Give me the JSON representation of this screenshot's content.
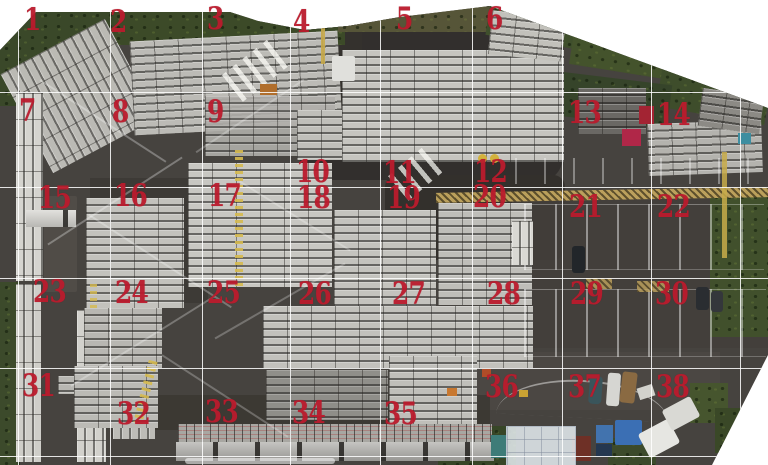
{
  "canvas": {
    "width": 768,
    "height": 465,
    "page_background": "#ffffff"
  },
  "photo": {
    "base_color": "#46433f",
    "clip": [
      [
        0,
        50
      ],
      [
        36,
        12
      ],
      [
        230,
        12
      ],
      [
        258,
        21
      ],
      [
        305,
        30
      ],
      [
        348,
        26
      ],
      [
        400,
        17
      ],
      [
        490,
        6
      ],
      [
        768,
        108
      ],
      [
        768,
        355
      ],
      [
        712,
        465
      ],
      [
        0,
        465
      ]
    ]
  },
  "grid": {
    "line_color": "rgba(255,255,255,0.85)",
    "vertical_x": [
      18,
      110,
      202,
      290,
      380,
      472,
      562,
      651,
      740
    ],
    "horizontal_y": [
      92,
      187,
      278,
      368,
      456
    ]
  },
  "labels": {
    "color": "#bb1b2d",
    "items": [
      {
        "n": "1",
        "x": 24,
        "y": 10
      },
      {
        "n": "2",
        "x": 110,
        "y": 12
      },
      {
        "n": "3",
        "x": 207,
        "y": 9
      },
      {
        "n": "4",
        "x": 293,
        "y": 12
      },
      {
        "n": "5",
        "x": 396,
        "y": 9
      },
      {
        "n": "6",
        "x": 486,
        "y": 9
      },
      {
        "n": "7",
        "x": 19,
        "y": 101
      },
      {
        "n": "8",
        "x": 112,
        "y": 102
      },
      {
        "n": "9",
        "x": 207,
        "y": 102
      },
      {
        "n": "10",
        "x": 296,
        "y": 162
      },
      {
        "n": "11",
        "x": 383,
        "y": 163
      },
      {
        "n": "12",
        "x": 474,
        "y": 162
      },
      {
        "n": "13",
        "x": 568,
        "y": 103
      },
      {
        "n": "14",
        "x": 657,
        "y": 105
      },
      {
        "n": "15",
        "x": 38,
        "y": 188
      },
      {
        "n": "16",
        "x": 114,
        "y": 186
      },
      {
        "n": "17",
        "x": 208,
        "y": 186
      },
      {
        "n": "18",
        "x": 297,
        "y": 188
      },
      {
        "n": "19",
        "x": 387,
        "y": 188
      },
      {
        "n": "20",
        "x": 473,
        "y": 187
      },
      {
        "n": "21",
        "x": 569,
        "y": 197
      },
      {
        "n": "22",
        "x": 657,
        "y": 197
      },
      {
        "n": "23",
        "x": 33,
        "y": 282
      },
      {
        "n": "24",
        "x": 115,
        "y": 283
      },
      {
        "n": "25",
        "x": 207,
        "y": 283
      },
      {
        "n": "26",
        "x": 298,
        "y": 284
      },
      {
        "n": "27",
        "x": 392,
        "y": 284
      },
      {
        "n": "28",
        "x": 487,
        "y": 284
      },
      {
        "n": "29",
        "x": 570,
        "y": 284
      },
      {
        "n": "30",
        "x": 655,
        "y": 284
      },
      {
        "n": "31",
        "x": 22,
        "y": 376
      },
      {
        "n": "32",
        "x": 117,
        "y": 404
      },
      {
        "n": "33",
        "x": 205,
        "y": 402
      },
      {
        "n": "34",
        "x": 292,
        "y": 403
      },
      {
        "n": "35",
        "x": 384,
        "y": 404
      },
      {
        "n": "36",
        "x": 485,
        "y": 377
      },
      {
        "n": "37",
        "x": 568,
        "y": 377
      },
      {
        "n": "38",
        "x": 656,
        "y": 377
      }
    ]
  },
  "regions": [
    {
      "n": "dark-wet-asphalt",
      "x": 300,
      "y": 18,
      "w": 262,
      "h": 162,
      "c": "#302e2b",
      "o": 0.9,
      "br": 20
    },
    {
      "n": "gate-road",
      "x": 300,
      "y": 20,
      "w": 62,
      "h": 140,
      "c": "#34312d"
    },
    {
      "n": "dark-asphalt-mid",
      "x": 385,
      "y": 175,
      "w": 180,
      "h": 85,
      "c": "#33302c",
      "br": 12
    },
    {
      "n": "asphalt-alley",
      "x": 90,
      "y": 178,
      "w": 118,
      "h": 125,
      "c": "#3b3834",
      "o": 0.8
    },
    {
      "n": "road-bottom",
      "x": 470,
      "y": 352,
      "w": 250,
      "h": 58,
      "c": "#4b4844",
      "o": 0.9
    },
    {
      "n": "parking-lot",
      "x": 512,
      "y": 198,
      "w": 256,
      "h": 150,
      "c": "#423f3b",
      "o": 0.9
    },
    {
      "n": "asphalt-bottom",
      "x": 150,
      "y": 395,
      "w": 340,
      "h": 35,
      "c": "#38352f",
      "o": 0.7
    },
    {
      "n": "hedge-top",
      "x": 60,
      "y": 0,
      "w": 285,
      "h": 45,
      "c": "#3c4a28",
      "p": "veg"
    },
    {
      "n": "hedge-top-right",
      "x": 338,
      "y": 0,
      "w": 160,
      "h": 32,
      "c": "#565538",
      "p": "veg"
    },
    {
      "n": "vegetation-topleft",
      "x": 0,
      "y": 10,
      "w": 114,
      "h": 96,
      "c": "#3a4829",
      "p": "veg"
    },
    {
      "n": "hedge-ne-1",
      "x": 488,
      "y": 2,
      "w": 115,
      "h": 42,
      "c": "#3f4f2c",
      "p": "veg",
      "r": 9
    },
    {
      "n": "hedge-ne-2",
      "x": 572,
      "y": 26,
      "w": 125,
      "h": 48,
      "c": "#44532c",
      "p": "veg",
      "r": 9
    },
    {
      "n": "hedge-ne-3",
      "x": 660,
      "y": 58,
      "w": 110,
      "h": 58,
      "c": "#3e4d2b",
      "p": "veg",
      "r": 10
    },
    {
      "n": "hedge-ne-4",
      "x": 552,
      "y": 78,
      "w": 118,
      "h": 44,
      "c": "#36442a",
      "p": "veg",
      "r": 7
    },
    {
      "n": "vegetation-right",
      "x": 710,
      "y": 192,
      "w": 58,
      "h": 145,
      "c": "#41502c",
      "p": "veg"
    },
    {
      "n": "vegetation-left-edge",
      "x": 0,
      "y": 282,
      "w": 20,
      "h": 183,
      "c": "#3c4a2b",
      "p": "veg"
    },
    {
      "n": "vegetation-bottom-mid",
      "x": 438,
      "y": 426,
      "w": 78,
      "h": 39,
      "c": "#374627",
      "p": "veg"
    },
    {
      "n": "vegetation-bottom-right",
      "x": 608,
      "y": 438,
      "w": 48,
      "h": 27,
      "c": "#3c4a2b",
      "p": "veg"
    },
    {
      "n": "vegetation-br-2",
      "x": 690,
      "y": 383,
      "w": 38,
      "h": 40,
      "c": "#46552e",
      "p": "veg"
    },
    {
      "n": "vegetation-br-3",
      "x": 715,
      "y": 408,
      "w": 30,
      "h": 45,
      "c": "#3a4827",
      "p": "veg"
    },
    {
      "n": "herringbone-trucks",
      "x": 20,
      "y": 40,
      "w": 118,
      "h": 112,
      "c": "#c2c1bc",
      "p": "stacks-v",
      "r": -28,
      "o": 0.95
    },
    {
      "n": "stack-rows-zone2",
      "x": 132,
      "y": 36,
      "w": 208,
      "h": 94,
      "c": "#bcbbb6",
      "p": "stacks",
      "r": -3
    },
    {
      "n": "stack-rows-zone9",
      "x": 205,
      "y": 96,
      "w": 130,
      "h": 60,
      "c": "#b0afaa",
      "p": "stacks",
      "o": 0.9
    },
    {
      "n": "stack-small-zone10",
      "x": 297,
      "y": 110,
      "w": 45,
      "h": 50,
      "c": "#c0bfba",
      "p": "stacks"
    },
    {
      "n": "stack-block-zone5",
      "x": 342,
      "y": 50,
      "w": 222,
      "h": 112,
      "c": "#c6c5c0",
      "p": "stacks"
    },
    {
      "n": "stack-block-zone6",
      "x": 490,
      "y": 14,
      "w": 74,
      "h": 44,
      "c": "#c2c1bb",
      "p": "stacks",
      "r": 6
    },
    {
      "n": "dark-stacks-zone13",
      "x": 578,
      "y": 88,
      "w": 68,
      "h": 46,
      "c": "#6a6864",
      "p": "stacks"
    },
    {
      "n": "stack-rows-zone14",
      "x": 648,
      "y": 122,
      "w": 114,
      "h": 52,
      "c": "#b4b3ae",
      "p": "stacks",
      "r": -2
    },
    {
      "n": "stacks-zone14-top",
      "x": 700,
      "y": 92,
      "w": 62,
      "h": 38,
      "c": "#8c8a85",
      "p": "stacks",
      "r": 8
    },
    {
      "n": "trailers-left-1",
      "x": 16,
      "y": 93,
      "w": 27,
      "h": 188,
      "c": "#d5d4cf",
      "p": "stacks-v"
    },
    {
      "n": "trailers-left-2",
      "x": 16,
      "y": 284,
      "w": 25,
      "h": 178,
      "c": "#cfcec9",
      "p": "stacks-v"
    },
    {
      "n": "dark-roof-building",
      "x": 44,
      "y": 196,
      "w": 33,
      "h": 96,
      "c": "#504c47",
      "br": 2
    },
    {
      "n": "trucks-horizontal",
      "x": 26,
      "y": 210,
      "w": 50,
      "h": 17,
      "c": "#d8d7d2",
      "p": "segments"
    },
    {
      "n": "trailers-zone31-a",
      "x": 77,
      "y": 310,
      "w": 29,
      "h": 152,
      "c": "#d2d1cc",
      "p": "stacks-v"
    },
    {
      "n": "trailers-zone31-b",
      "x": 113,
      "y": 313,
      "w": 42,
      "h": 126,
      "c": "#bdbcb7",
      "p": "stacks-v"
    },
    {
      "n": "stack-small-zone31",
      "x": 58,
      "y": 376,
      "w": 32,
      "h": 18,
      "c": "#b8b7b2",
      "p": "stacks"
    },
    {
      "n": "stack-block-zone16a",
      "x": 86,
      "y": 198,
      "w": 98,
      "h": 110,
      "c": "#c3c2bd",
      "p": "stacks"
    },
    {
      "n": "stack-block-zone17",
      "x": 188,
      "y": 163,
      "w": 144,
      "h": 124,
      "c": "#c8c7c2",
      "p": "stacks"
    },
    {
      "n": "stack-block-zone19",
      "x": 334,
      "y": 210,
      "w": 102,
      "h": 98,
      "c": "#c4c3be",
      "p": "stacks"
    },
    {
      "n": "stack-block-zone20",
      "x": 438,
      "y": 203,
      "w": 94,
      "h": 102,
      "c": "#bfbeb9",
      "p": "stacks"
    },
    {
      "n": "stack-block-zone24",
      "x": 84,
      "y": 308,
      "w": 78,
      "h": 60,
      "c": "#b8b7b2",
      "p": "stacks"
    },
    {
      "n": "stack-band-zone26",
      "x": 263,
      "y": 306,
      "w": 270,
      "h": 62,
      "c": "#c2c1bc",
      "p": "stacks"
    },
    {
      "n": "stack-block-zone32",
      "x": 74,
      "y": 366,
      "w": 84,
      "h": 62,
      "c": "#bbbab5",
      "p": "stacks"
    },
    {
      "n": "stack-block-zone35",
      "x": 389,
      "y": 356,
      "w": 88,
      "h": 74,
      "c": "#c0bfba",
      "p": "stacks"
    },
    {
      "n": "stack-sparse-zone33",
      "x": 266,
      "y": 370,
      "w": 122,
      "h": 50,
      "c": "#9e9d98",
      "p": "stacks",
      "o": 0.85
    },
    {
      "n": "speckle-stack-row",
      "x": 178,
      "y": 424,
      "w": 314,
      "h": 19,
      "c": "#a8a7a2",
      "p": "speckle"
    },
    {
      "n": "slab-row-ww",
      "x": 176,
      "y": 442,
      "w": 318,
      "h": 19,
      "c": "#b2b1ad",
      "p": "segments"
    },
    {
      "n": "white-curb-bottom",
      "x": 185,
      "y": 458,
      "w": 150,
      "h": 6,
      "c": "rgba(255,255,255,0.55)",
      "br": 3
    },
    {
      "n": "zebra-crossing-gate",
      "x": 226,
      "y": 53,
      "w": 60,
      "h": 34,
      "p": "zebra",
      "r": -38,
      "o": 0.85
    },
    {
      "n": "zebra-crossing-mid",
      "x": 393,
      "y": 158,
      "w": 45,
      "h": 32,
      "p": "zebra",
      "r": -40,
      "o": 0.8
    },
    {
      "n": "yellow-pipe-rack",
      "x": 436,
      "y": 190,
      "w": 332,
      "h": 10,
      "c": "#c2a55e",
      "p": "hatch-y",
      "r": -1,
      "o": 0.95
    },
    {
      "n": "white-post-row",
      "x": 515,
      "y": 158,
      "w": 253,
      "h": 26,
      "p": "posts",
      "o": 0.6
    },
    {
      "n": "parking-slots-row1",
      "x": 524,
      "y": 204,
      "w": 240,
      "h": 64,
      "p": "slots",
      "o": 0.8
    },
    {
      "n": "parking-slots-row2",
      "x": 524,
      "y": 289,
      "w": 242,
      "h": 66,
      "p": "slots",
      "o": 0.8
    },
    {
      "n": "yellow-hatch-1",
      "x": 586,
      "y": 278,
      "w": 26,
      "h": 11,
      "c": "#c2a55e",
      "p": "hatch-y",
      "o": 0.8
    },
    {
      "n": "yellow-hatch-2",
      "x": 637,
      "y": 281,
      "w": 32,
      "h": 11,
      "c": "#c2a55e",
      "p": "hatch-y",
      "o": 0.8
    },
    {
      "n": "yellow-line-right",
      "x": 722,
      "y": 152,
      "w": 5,
      "h": 106,
      "c": "#c8ab4a",
      "o": 0.85
    },
    {
      "n": "yellow-line-gate",
      "x": 321,
      "y": 28,
      "w": 4,
      "h": 36,
      "c": "#c8ab4a",
      "o": 0.9
    },
    {
      "n": "crane-truss-1",
      "x": 235,
      "y": 150,
      "w": 8,
      "h": 138,
      "p": "truss-v",
      "o": 0.9
    },
    {
      "n": "crane-truss-2",
      "x": 141,
      "y": 360,
      "w": 9,
      "h": 64,
      "p": "truss-v",
      "r": 14,
      "o": 0.9
    },
    {
      "n": "crane-truss-3",
      "x": 90,
      "y": 284,
      "w": 7,
      "h": 28,
      "p": "truss-v",
      "o": 0.8
    },
    {
      "n": "lane-mark-1",
      "x": 28,
      "y": 120,
      "w": 150,
      "h": 2,
      "c": "rgba(255,255,255,0.3)",
      "r": 33
    },
    {
      "n": "lane-mark-2",
      "x": 35,
      "y": 200,
      "w": 160,
      "h": 2,
      "c": "rgba(255,255,255,0.3)",
      "r": -33
    },
    {
      "n": "lane-mark-3",
      "x": 75,
      "y": 260,
      "w": 170,
      "h": 2,
      "c": "rgba(255,255,255,0.28)",
      "r": 33
    },
    {
      "n": "lane-mark-4",
      "x": 58,
      "y": 340,
      "w": 170,
      "h": 2,
      "c": "rgba(255,255,255,0.28)",
      "r": -32
    },
    {
      "n": "lane-mark-5",
      "x": 150,
      "y": 395,
      "w": 150,
      "h": 2,
      "c": "rgba(255,255,255,0.25)",
      "r": 33
    },
    {
      "n": "lane-mark-6",
      "x": 185,
      "y": 115,
      "w": 130,
      "h": 2,
      "c": "rgba(255,255,255,0.25)",
      "r": -34
    },
    {
      "n": "lane-mark-7",
      "x": 205,
      "y": 300,
      "w": 150,
      "h": 2,
      "c": "rgba(255,255,255,0.25)",
      "r": -30
    },
    {
      "n": "lane-mark-8",
      "x": 230,
      "y": 215,
      "w": 130,
      "h": 2,
      "c": "rgba(255,255,255,0.25)",
      "r": 32
    },
    {
      "n": "yellow-dot-1",
      "x": 478,
      "y": 154,
      "w": 9,
      "h": 9,
      "c": "#d3b23c",
      "br": 5
    },
    {
      "n": "yellow-dot-2",
      "x": 490,
      "y": 154,
      "w": 9,
      "h": 9,
      "c": "#d3b23c",
      "br": 5
    },
    {
      "n": "road-curve-mark",
      "x": 497,
      "y": 380,
      "w": 172,
      "h": 36,
      "p": "arc",
      "r": 3
    },
    {
      "n": "white-vans-parking",
      "x": 512,
      "y": 221,
      "w": 21,
      "h": 44,
      "c": "#d9d8d3",
      "p": "stacks-v"
    },
    {
      "n": "parked-car-dark",
      "x": 572,
      "y": 246,
      "w": 13,
      "h": 27,
      "c": "#22262a",
      "br": 3
    },
    {
      "n": "parked-car-2",
      "x": 696,
      "y": 287,
      "w": 13,
      "h": 23,
      "c": "#2a2d31",
      "br": 3
    },
    {
      "n": "parked-car-3",
      "x": 711,
      "y": 291,
      "w": 12,
      "h": 21,
      "c": "#34373b",
      "br": 3
    },
    {
      "n": "suv-road",
      "x": 589,
      "y": 376,
      "w": 13,
      "h": 28,
      "c": "#3a555b",
      "br": 4,
      "r": 4
    },
    {
      "n": "truck-cab-white",
      "x": 607,
      "y": 373,
      "w": 13,
      "h": 33,
      "c": "#d6d6d2",
      "br": 3,
      "r": 4
    },
    {
      "n": "truck-cargo-brown",
      "x": 621,
      "y": 372,
      "w": 15,
      "h": 31,
      "c": "#8a6a42",
      "br": 3,
      "r": 7
    },
    {
      "n": "forklift-orange",
      "x": 447,
      "y": 388,
      "w": 10,
      "h": 8,
      "c": "#c87830"
    },
    {
      "n": "forklift-yellow",
      "x": 519,
      "y": 390,
      "w": 9,
      "h": 7,
      "c": "#c9a233"
    },
    {
      "n": "orange-item-road",
      "x": 482,
      "y": 369,
      "w": 9,
      "h": 8,
      "c": "#b04c28"
    },
    {
      "n": "red-item-zone13",
      "x": 639,
      "y": 106,
      "w": 15,
      "h": 18,
      "c": "#a32433"
    },
    {
      "n": "magenta-item-zone13",
      "x": 622,
      "y": 129,
      "w": 19,
      "h": 17,
      "c": "#b02748"
    },
    {
      "n": "teal-container-right",
      "x": 738,
      "y": 133,
      "w": 13,
      "h": 11,
      "c": "#3e8ea0"
    },
    {
      "n": "gate-hut",
      "x": 332,
      "y": 56,
      "w": 23,
      "h": 25,
      "c": "#e0e0dc",
      "br": 2
    },
    {
      "n": "orange-machine-gate",
      "x": 260,
      "y": 84,
      "w": 17,
      "h": 11,
      "c": "#b06e2c"
    },
    {
      "n": "blue-container",
      "x": 615,
      "y": 420,
      "w": 27,
      "h": 25,
      "c": "#3b6fb4",
      "br": 2
    },
    {
      "n": "blue-pallets",
      "x": 596,
      "y": 425,
      "w": 17,
      "h": 18,
      "c": "#4273ae"
    },
    {
      "n": "navy-pallets",
      "x": 596,
      "y": 444,
      "w": 16,
      "h": 13,
      "c": "#243750"
    },
    {
      "n": "red-container",
      "x": 572,
      "y": 436,
      "w": 19,
      "h": 25,
      "c": "#6e3026"
    },
    {
      "n": "teal-equipment",
      "x": 491,
      "y": 435,
      "w": 16,
      "h": 23,
      "c": "#3e7c78"
    },
    {
      "n": "white-canopy",
      "x": 506,
      "y": 426,
      "w": 68,
      "h": 39,
      "c": "rgba(232,238,243,0.85)",
      "p": "canopy"
    },
    {
      "n": "tent-1",
      "x": 642,
      "y": 425,
      "w": 34,
      "h": 27,
      "c": "#e6e6e2",
      "r": -28,
      "br": 3
    },
    {
      "n": "tent-2",
      "x": 665,
      "y": 402,
      "w": 32,
      "h": 23,
      "c": "#d9d9d4",
      "r": -28,
      "br": 3
    },
    {
      "n": "tent-small",
      "x": 638,
      "y": 386,
      "w": 16,
      "h": 12,
      "c": "#d2d2cc",
      "r": -18
    }
  ]
}
